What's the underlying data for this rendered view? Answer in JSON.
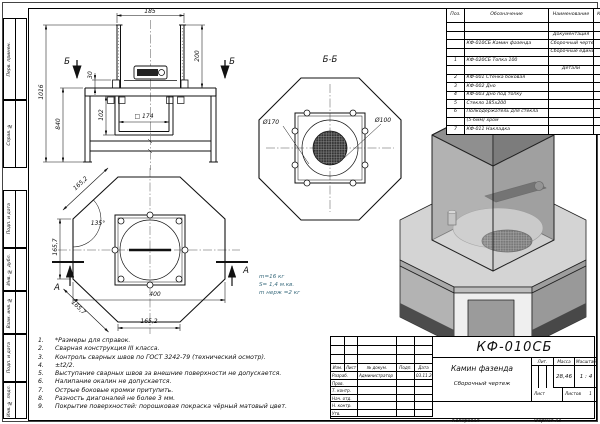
{
  "colors": {
    "line": "#1a1a1a",
    "annotation_blue": "#3a6b7d",
    "paper": "#ffffff"
  },
  "frame": {
    "margin_cells": [
      {
        "label": "Перв. примен.",
        "top": 18,
        "height": 82
      },
      {
        "label": "Справ. №",
        "top": 100,
        "height": 68
      },
      {
        "label": "Подп. и дата",
        "top": 190,
        "height": 58
      },
      {
        "label": "Инв. № дубл.",
        "top": 248,
        "height": 43
      },
      {
        "label": "Взам. инв. №",
        "top": 291,
        "height": 43
      },
      {
        "label": "Подп. и дата",
        "top": 334,
        "height": 48
      },
      {
        "label": "Инв. № подл.",
        "top": 382,
        "height": 37
      }
    ]
  },
  "parts_table": {
    "headers": [
      "Поз.",
      "Обозначение",
      "Наименование",
      "Кол."
    ],
    "rows": [
      {
        "pos": "",
        "dsg": "",
        "name": "",
        "qty": "",
        "sec": false
      },
      {
        "pos": "",
        "dsg": "",
        "name": "Документация",
        "qty": "",
        "sec": true
      },
      {
        "pos": "",
        "dsg": "КФ-010СБ Камин фазенда",
        "name": "Сборочный чертеж",
        "qty": "1",
        "sec": false
      },
      {
        "pos": "",
        "dsg": "",
        "name": "Сборочные единицы",
        "qty": "",
        "sec": true
      },
      {
        "pos": "1",
        "dsg": "КФ-020СБ Топка 100",
        "name": "",
        "qty": "1",
        "sec": false
      },
      {
        "pos": "",
        "dsg": "",
        "name": "Детали",
        "qty": "",
        "sec": true
      },
      {
        "pos": "2",
        "dsg": "КФ-001 Стенка боковая",
        "name": "",
        "qty": "2",
        "sec": false
      },
      {
        "pos": "3",
        "dsg": "КФ-002 Дно",
        "name": "",
        "qty": "1",
        "sec": false
      },
      {
        "pos": "4",
        "dsg": "КФ-003 Дно под топку",
        "name": "",
        "qty": "1",
        "sec": false
      },
      {
        "pos": "5",
        "dsg": "Стекло 185х200",
        "name": "",
        "qty": "4",
        "sec": false
      },
      {
        "pos": "6",
        "dsg": "Полкодержатель для стекла",
        "name": "",
        "qty": "8",
        "sec": false
      },
      {
        "pos": "",
        "dsg": "(5-6мм) хром",
        "name": "",
        "qty": "",
        "sec": false
      },
      {
        "pos": "7",
        "dsg": "КФ-011 Накладка",
        "name": "",
        "qty": "2",
        "sec": false
      }
    ]
  },
  "notes": [
    "*Размеры для справок.",
    "Сварная конструкция III класса.",
    "Контроль сварных швов по ГОСТ 3242-79 (технический осмотр).",
    "±t2/2.",
    "Выступание сварных швов за внешние поверхности не допускается.",
    "Налипание окалин не допускается.",
    "Острые боковые кромки притупить.",
    "Разность диагоналей не более 3 мм.",
    "Покрытие поверхностей: порошковая покраска чёрный матовый цвет."
  ],
  "title_block": {
    "doc_number": "КФ-010СБ",
    "title": "Камин фазенда",
    "doc_type": "Сборочный чертеж",
    "header_row": [
      "Изм.",
      "Лист",
      "№ докум.",
      "Подп.",
      "Дата"
    ],
    "sig_rows": [
      [
        "Разраб.",
        "Администратор",
        "",
        "03.11.20"
      ],
      [
        "Пров.",
        "",
        "",
        ""
      ],
      [
        "Т. контр.",
        "",
        "",
        ""
      ],
      [
        "Нач. отд.",
        "",
        "",
        ""
      ],
      [
        "Н. контр.",
        "",
        "",
        ""
      ],
      [
        "Утв.",
        "",
        "",
        ""
      ]
    ],
    "lit_label": "Лит.",
    "mass_label": "Масса",
    "scale_label": "Масштаб",
    "mass": "28,46",
    "scale": "1 : 4",
    "sheet_label": "Лист",
    "sheets_label": "Листов",
    "sheets": "1",
    "copied_label": "Копировал",
    "format_label": "Формат А3"
  },
  "drawing": {
    "labels": [
      {
        "t": "185",
        "x": 150,
        "y": 12
      },
      {
        "t": "200",
        "x": 198,
        "y": 56,
        "r": -90
      },
      {
        "t": "1016",
        "x": 42,
        "y": 92,
        "r": -90
      },
      {
        "t": "840",
        "x": 59,
        "y": 124,
        "r": -90
      },
      {
        "t": "30",
        "x": 91,
        "y": 75,
        "r": -90
      },
      {
        "t": "102",
        "x": 102,
        "y": 115,
        "r": -90
      },
      {
        "t": "□ 174",
        "x": 144,
        "y": 117
      },
      {
        "t": "Б",
        "x": 67,
        "y": 62,
        "cls": "sec"
      },
      {
        "t": "Б",
        "x": 232,
        "y": 62,
        "cls": "sec"
      },
      {
        "t": "Б-Б",
        "x": 330,
        "y": 60,
        "cls": "sec"
      },
      {
        "t": "Ø170",
        "x": 271,
        "y": 123
      },
      {
        "t": "Ø100",
        "x": 383,
        "y": 121
      },
      {
        "t": "165,2",
        "x": 81,
        "y": 184,
        "r": -43
      },
      {
        "t": "135°",
        "x": 98,
        "y": 224
      },
      {
        "t": "165,7",
        "x": 56,
        "y": 247,
        "r": -90
      },
      {
        "t": "165,7",
        "x": 78,
        "y": 308,
        "r": 44
      },
      {
        "t": "400",
        "x": 155,
        "y": 295
      },
      {
        "t": "165,2",
        "x": 149,
        "y": 322
      },
      {
        "t": "А",
        "x": 57,
        "y": 288,
        "cls": "sec"
      },
      {
        "t": "А",
        "x": 246,
        "y": 271,
        "cls": "sec"
      },
      {
        "t": "m=16 кг",
        "x": 259,
        "y": 278,
        "cls": "blue",
        "a": "l"
      },
      {
        "t": "S= 1,4 м.кв.",
        "x": 259,
        "y": 286,
        "cls": "blue",
        "a": "l"
      },
      {
        "t": "m нерж =2 кг",
        "x": 259,
        "y": 294,
        "cls": "blue",
        "a": "l"
      }
    ]
  }
}
